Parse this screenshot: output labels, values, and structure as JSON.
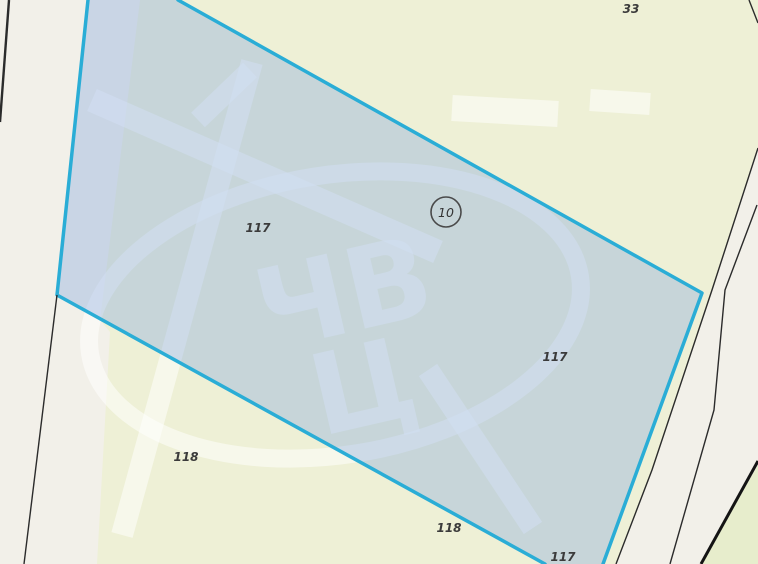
{
  "map": {
    "type": "cadastral-parcel-map",
    "selected_parcel_marker": "10",
    "labels": [
      {
        "text": "33",
        "x": 631,
        "y": 13
      },
      {
        "text": "117",
        "x": 258,
        "y": 232
      },
      {
        "text": "117",
        "x": 555,
        "y": 361
      },
      {
        "text": "118",
        "x": 186,
        "y": 461
      },
      {
        "text": "118",
        "x": 449,
        "y": 532
      },
      {
        "text": "117",
        "x": 563,
        "y": 561
      }
    ],
    "marker": {
      "cx": 446,
      "cy": 212,
      "r": 15,
      "text": "10",
      "text_y": 217
    },
    "geometry": {
      "road_left": "0,0 140,0 100,320 110,332 97,564 0,564",
      "road_right": "758,148 712,290 652,470 616,564 758,564",
      "corner_wedge": "758,465 701,564 758,564",
      "selection": "88,0 178,0 702,293 603,564 545,564 57,295",
      "selection_border_left": "88,0 57,295 545,564",
      "selection_border_right": "178,0 702,293 603,564",
      "black_left_top": "9,0 0,122",
      "black_left_bottom": "57,295 24,564",
      "black_right_1": "758,148 712,290 652,470 616,564",
      "black_right_2": "757,205 725,290 714,410 670,564",
      "black_right_heavy": "758,461 701,564",
      "black_corner_tick": "749,0 758,23"
    },
    "watermark": {
      "letters_top": "ЧВ",
      "letters_bottom": "Ц",
      "ellipse": {
        "cx": 335,
        "cy": 315,
        "rx": 248,
        "ry": 140
      },
      "bands": {
        "band1": "92,100 438,252",
        "band1_hook": "198,120 250,70",
        "band2": "252,62 122,535",
        "band3": "428,370 533,528",
        "blob1": "452,108 558,114",
        "blob2": "590,100 650,104"
      }
    }
  },
  "colors": {
    "background_parcel": "#eef0d6",
    "road": "#f2f0e9",
    "corner_parcel": "#e7edcc",
    "selection_fill": "rgba(125,162,224,0.35)",
    "selection_border": "#2aadd6",
    "boundary_line": "#2b2b2b",
    "boundary_line_heavy": "#141414",
    "watermark": "rgba(255,255,255,0.5)",
    "label_text": "#3b3b3b"
  }
}
